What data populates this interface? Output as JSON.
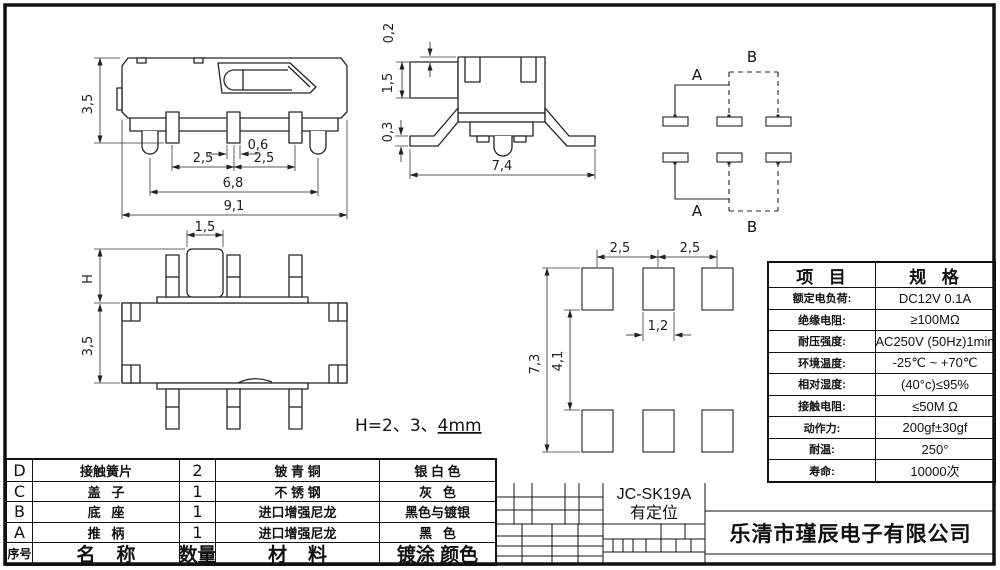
{
  "drawing": {
    "front_view": {
      "dims": {
        "height": "3,5",
        "pin_width": "0,6",
        "pitch_left": "2,5",
        "pitch_right": "2,5",
        "feet_span": "6,8"
      }
    },
    "top_view": {
      "dims": {
        "overall_width": "9,1",
        "knob_width": "1,5",
        "knob_height": "H",
        "body_depth": "3,5"
      }
    },
    "side_view": {
      "dims": {
        "cover_lip": "0,2",
        "knob_height": "1,5",
        "foot_thickness": "0,3",
        "overall_width": "7,4"
      }
    },
    "circuit": {
      "pole_label": "A",
      "throw_label": "B"
    },
    "footprint": {
      "dims": {
        "pitch_left": "2,5",
        "pitch_right": "2,5",
        "pad_width": "1,2",
        "outer_span": "7,3",
        "inner_span": "4,1"
      }
    },
    "h_note": {
      "prefix": "H=2、3、",
      "underlined": "4mm"
    }
  },
  "spec_table": {
    "headers": {
      "item": "项  目",
      "spec": "规  格"
    },
    "rows": [
      {
        "item": "额定电负荷:",
        "spec": "DC12V 0.1A"
      },
      {
        "item": "绝缘电阻:",
        "spec": "≥100MΩ"
      },
      {
        "item": "耐压强度:",
        "spec": "AC250V (50Hz)1min"
      },
      {
        "item": "环境温度:",
        "spec": "-25℃ ~ +70℃"
      },
      {
        "item": "相对湿度:",
        "spec": "(40°c)≤95%"
      },
      {
        "item": "接触电阻:",
        "spec": "≤50M Ω"
      },
      {
        "item": "动作力:",
        "spec": "200gf±30gf"
      },
      {
        "item": "耐温:",
        "spec": "250°"
      },
      {
        "item": "寿命:",
        "spec": "10000次"
      }
    ]
  },
  "parts_table": {
    "rows": [
      {
        "no": "D",
        "name": "接触簧片",
        "qty": "2",
        "material": "铍 青 铜",
        "finish": "银 白 色"
      },
      {
        "no": "C",
        "name": "盖   子",
        "qty": "1",
        "material": "不 锈 钢",
        "finish": "灰   色"
      },
      {
        "no": "B",
        "name": "底   座",
        "qty": "1",
        "material": "进口增强尼龙",
        "finish": "黑色与镀银"
      },
      {
        "no": "A",
        "name": "推   柄",
        "qty": "1",
        "material": "进口增强尼龙",
        "finish": "黑   色"
      }
    ],
    "footer": {
      "no": "序号",
      "name": "名    称",
      "qty": "数量",
      "material": "材    料",
      "finish": "镀涂 颜色"
    }
  },
  "title_block": {
    "model": "JC-SK19A",
    "feature": "有定位",
    "company": "乐清市瑾辰电子有限公司"
  }
}
